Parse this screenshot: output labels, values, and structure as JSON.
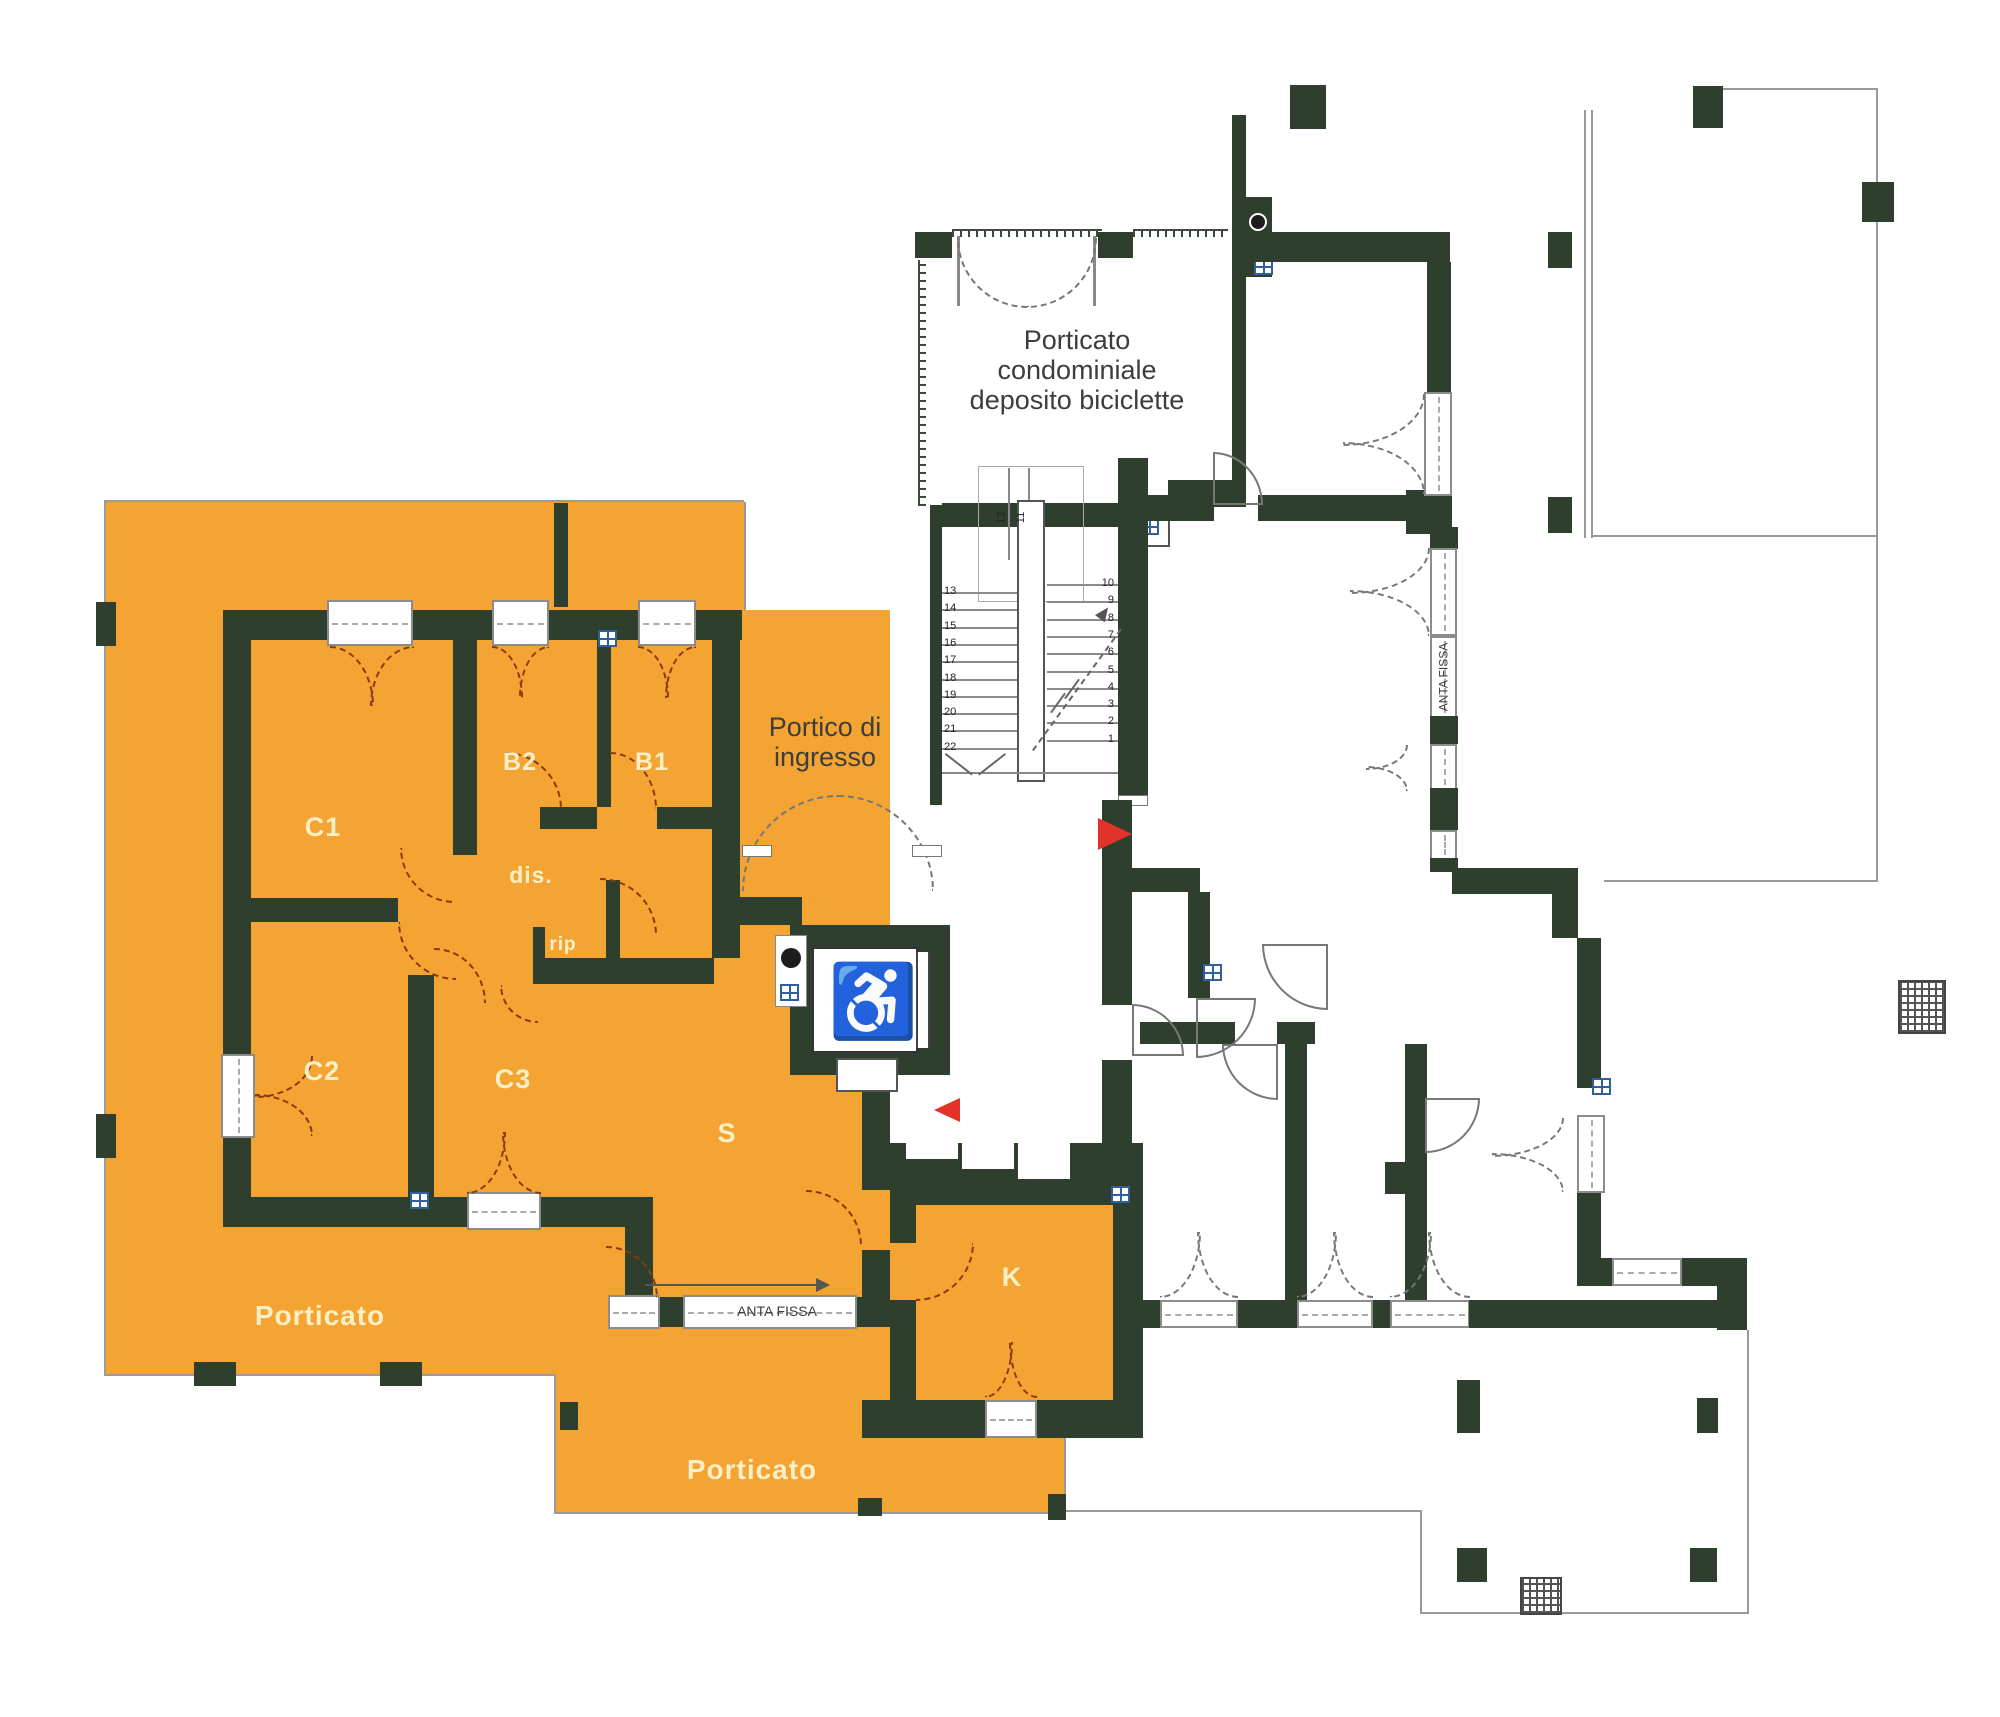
{
  "colors": {
    "wall": "#2f3f2e",
    "highlight": "#F4A433",
    "room_label": "#FBEFC6",
    "door_arc": "#8a3a12",
    "red_arrow": "#E2322A",
    "fixture": "#2F5F9E"
  },
  "rooms": {
    "c1": "C1",
    "c2": "C2",
    "c3": "C3",
    "b1": "B1",
    "b2": "B2",
    "dis": "dis.",
    "rip": "rip",
    "s": "S",
    "k": "K"
  },
  "areas": {
    "porticato_left": "Porticato",
    "porticato_bottom": "Porticato",
    "porch_line1": "Porticato",
    "porch_line2": "condominiale",
    "porch_line3": "deposito biciclette",
    "portico_line1": "Portico di",
    "portico_line2": "ingresso"
  },
  "windows": {
    "anta_fissa_horizontal": "ANTA FISSA",
    "anta_fissa_vertical": "ANTA FISSA"
  },
  "icons": {
    "wheelchair": "♿"
  },
  "stairs": {
    "left_numbers": [
      "13",
      "14",
      "15",
      "16",
      "17",
      "18",
      "19",
      "20",
      "21",
      "22"
    ],
    "right_numbers": [
      "10",
      "9",
      "8",
      "7",
      "6",
      "5",
      "4",
      "3",
      "2",
      "1"
    ],
    "upper_numbers": [
      "12",
      "11"
    ]
  }
}
